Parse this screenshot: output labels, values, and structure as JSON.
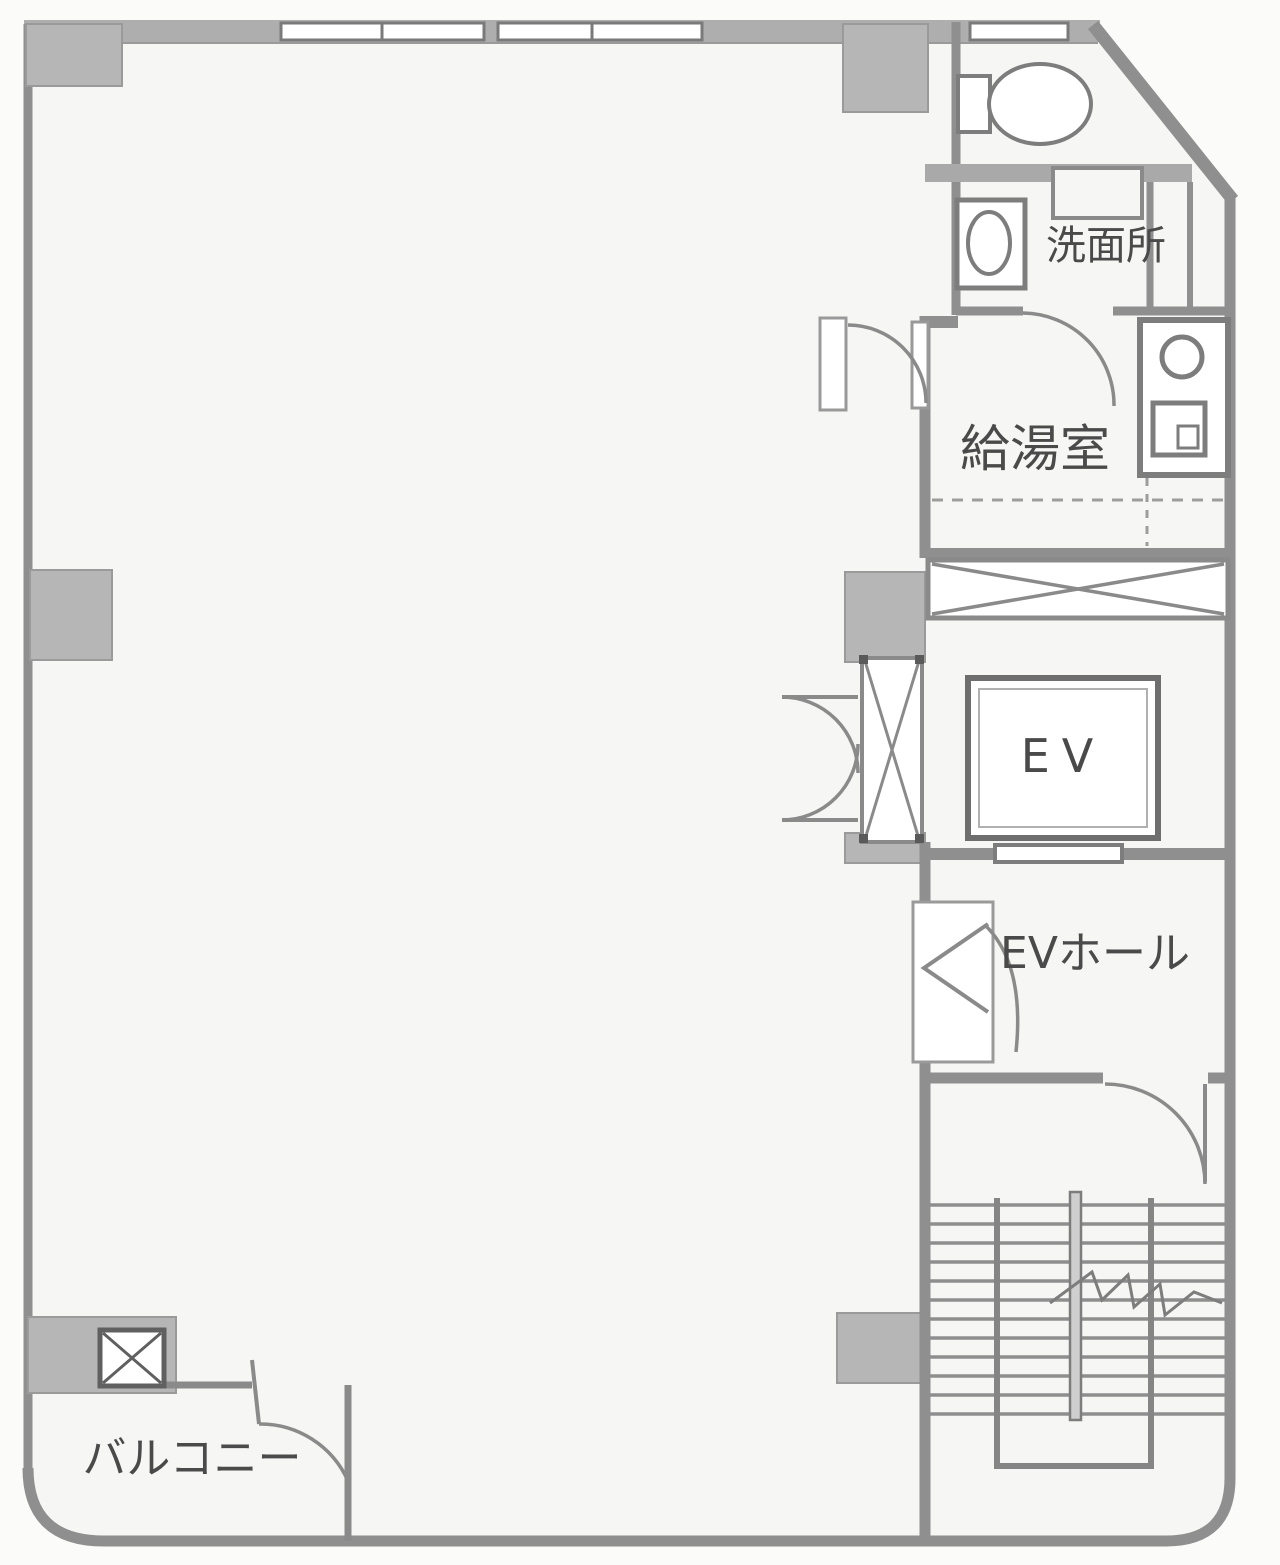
{
  "plan": {
    "type": "building floor plan (scanned)",
    "labels": {
      "washroom": "洗面所",
      "kitchenette": "給湯室",
      "elevator": "EV",
      "elevator_hall": "EVホール",
      "balcony": "バルコニー"
    },
    "colors": {
      "paper": "#fbfbfa",
      "floor": "#f6f6f4",
      "wall_line": "#8f8f8f",
      "wall_band": "#aeaeae",
      "column_fill": "#b6b6b6",
      "fixture_line": "#7d7d7d",
      "label_text": "#4a4a4a"
    }
  }
}
